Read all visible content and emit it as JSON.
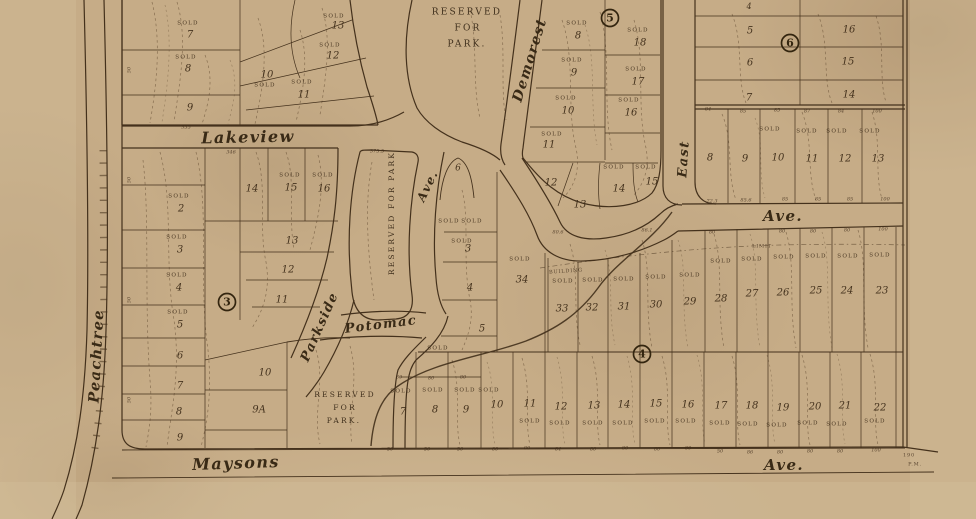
{
  "map": {
    "colors": {
      "paper": "#c6ac87",
      "paper_light": "#d8c4a0",
      "paper_dark": "#b39872",
      "ink": "#44311c"
    },
    "streets": [
      {
        "t": "Lakeview",
        "x": 248,
        "y": 138,
        "s": 16,
        "r": -1
      },
      {
        "t": "Peachtree",
        "x": 97,
        "y": 356,
        "s": 14.5,
        "r": -87
      },
      {
        "t": "Demorest",
        "x": 530,
        "y": 60,
        "s": 14,
        "r": -73
      },
      {
        "t": "East",
        "x": 684,
        "y": 159,
        "s": 13,
        "r": -86
      },
      {
        "t": "Ave.",
        "x": 783,
        "y": 217,
        "s": 15,
        "r": 0
      },
      {
        "t": "Ave.",
        "x": 428,
        "y": 186,
        "s": 12,
        "r": -64
      },
      {
        "t": "Potomac",
        "x": 381,
        "y": 325,
        "s": 13,
        "r": -7
      },
      {
        "t": "Parkside",
        "x": 320,
        "y": 327,
        "s": 13,
        "r": -66
      },
      {
        "t": "Maysons",
        "x": 236,
        "y": 464,
        "s": 16,
        "r": -2
      },
      {
        "t": "Ave.",
        "x": 784,
        "y": 466,
        "s": 15,
        "r": 0
      }
    ],
    "parks": [
      {
        "t": "RESERVED",
        "x": 467,
        "y": 12,
        "s": 9,
        "r": 0
      },
      {
        "t": "FOR",
        "x": 468,
        "y": 28,
        "s": 9,
        "r": 0
      },
      {
        "t": "PARK.",
        "x": 467,
        "y": 44,
        "s": 9,
        "r": 0
      },
      {
        "t": "RESERVED FOR PARK",
        "x": 392,
        "y": 213,
        "s": 7.5,
        "r": -90
      },
      {
        "t": "RESERVED",
        "x": 345,
        "y": 395,
        "s": 7.5,
        "r": 0
      },
      {
        "t": "FOR",
        "x": 345,
        "y": 408,
        "s": 7.5,
        "r": 0
      },
      {
        "t": "PARK.",
        "x": 344,
        "y": 421,
        "s": 7.5,
        "r": 0
      }
    ],
    "badges": [
      {
        "t": "3",
        "x": 227,
        "y": 302
      },
      {
        "t": "4",
        "x": 642,
        "y": 354
      },
      {
        "t": "5",
        "x": 610,
        "y": 18
      },
      {
        "t": "6",
        "x": 790,
        "y": 43
      }
    ],
    "sold_text": "SOLD",
    "solds": [
      {
        "x": 188,
        "y": 23
      },
      {
        "x": 186,
        "y": 57
      },
      {
        "x": 265,
        "y": 85
      },
      {
        "x": 302,
        "y": 82
      },
      {
        "x": 330,
        "y": 45
      },
      {
        "x": 334,
        "y": 16
      },
      {
        "x": 179,
        "y": 196
      },
      {
        "x": 177,
        "y": 237
      },
      {
        "x": 177,
        "y": 275
      },
      {
        "x": 178,
        "y": 312
      },
      {
        "x": 290,
        "y": 175
      },
      {
        "x": 323,
        "y": 175
      },
      {
        "x": 577,
        "y": 23
      },
      {
        "x": 572,
        "y": 60
      },
      {
        "x": 566,
        "y": 98
      },
      {
        "x": 638,
        "y": 30
      },
      {
        "x": 636,
        "y": 69
      },
      {
        "x": 629,
        "y": 100
      },
      {
        "x": 552,
        "y": 134
      },
      {
        "x": 614,
        "y": 167
      },
      {
        "x": 646,
        "y": 167
      },
      {
        "x": 770,
        "y": 129
      },
      {
        "x": 807,
        "y": 131
      },
      {
        "x": 837,
        "y": 131
      },
      {
        "x": 870,
        "y": 131
      },
      {
        "x": 563,
        "y": 281
      },
      {
        "x": 593,
        "y": 280
      },
      {
        "x": 624,
        "y": 279
      },
      {
        "x": 656,
        "y": 277
      },
      {
        "x": 690,
        "y": 275
      },
      {
        "x": 721,
        "y": 261
      },
      {
        "x": 752,
        "y": 259
      },
      {
        "x": 784,
        "y": 257
      },
      {
        "x": 816,
        "y": 256
      },
      {
        "x": 848,
        "y": 256
      },
      {
        "x": 880,
        "y": 255
      },
      {
        "x": 520,
        "y": 259
      },
      {
        "x": 449,
        "y": 221
      },
      {
        "x": 472,
        "y": 221
      },
      {
        "x": 462,
        "y": 241
      },
      {
        "x": 438,
        "y": 348
      },
      {
        "x": 401,
        "y": 391
      },
      {
        "x": 433,
        "y": 390
      },
      {
        "x": 465,
        "y": 390
      },
      {
        "x": 489,
        "y": 390
      },
      {
        "x": 530,
        "y": 421
      },
      {
        "x": 560,
        "y": 423
      },
      {
        "x": 593,
        "y": 423
      },
      {
        "x": 623,
        "y": 423
      },
      {
        "x": 655,
        "y": 421
      },
      {
        "x": 686,
        "y": 421
      },
      {
        "x": 720,
        "y": 423
      },
      {
        "x": 748,
        "y": 424
      },
      {
        "x": 777,
        "y": 425
      },
      {
        "x": 808,
        "y": 423
      },
      {
        "x": 837,
        "y": 424
      },
      {
        "x": 875,
        "y": 421
      }
    ],
    "lots": [
      {
        "t": "7",
        "x": 190,
        "y": 35
      },
      {
        "t": "8",
        "x": 188,
        "y": 69
      },
      {
        "t": "9",
        "x": 190,
        "y": 108
      },
      {
        "t": "10",
        "x": 267,
        "y": 75
      },
      {
        "t": "11",
        "x": 304,
        "y": 95
      },
      {
        "t": "12",
        "x": 333,
        "y": 56
      },
      {
        "t": "13",
        "x": 338,
        "y": 26
      },
      {
        "t": "2",
        "x": 181,
        "y": 209
      },
      {
        "t": "3",
        "x": 180,
        "y": 250
      },
      {
        "t": "4",
        "x": 179,
        "y": 288
      },
      {
        "t": "5",
        "x": 180,
        "y": 325
      },
      {
        "t": "6",
        "x": 180,
        "y": 356
      },
      {
        "t": "7",
        "x": 180,
        "y": 386
      },
      {
        "t": "8",
        "x": 179,
        "y": 412
      },
      {
        "t": "9",
        "x": 180,
        "y": 438
      },
      {
        "t": "14",
        "x": 252,
        "y": 189
      },
      {
        "t": "15",
        "x": 291,
        "y": 188
      },
      {
        "t": "16",
        "x": 324,
        "y": 189
      },
      {
        "t": "13",
        "x": 292,
        "y": 241
      },
      {
        "t": "12",
        "x": 288,
        "y": 270
      },
      {
        "t": "11",
        "x": 282,
        "y": 300
      },
      {
        "t": "10",
        "x": 265,
        "y": 373
      },
      {
        "t": "9A",
        "x": 259,
        "y": 410
      },
      {
        "t": "8",
        "x": 578,
        "y": 36
      },
      {
        "t": "9",
        "x": 574,
        "y": 73
      },
      {
        "t": "10",
        "x": 568,
        "y": 111
      },
      {
        "t": "11",
        "x": 549,
        "y": 145
      },
      {
        "t": "12",
        "x": 551,
        "y": 183
      },
      {
        "t": "13",
        "x": 580,
        "y": 205
      },
      {
        "t": "14",
        "x": 619,
        "y": 189
      },
      {
        "t": "15",
        "x": 652,
        "y": 182
      },
      {
        "t": "16",
        "x": 631,
        "y": 113
      },
      {
        "t": "17",
        "x": 638,
        "y": 82
      },
      {
        "t": "18",
        "x": 640,
        "y": 43
      },
      {
        "t": "4",
        "x": 749,
        "y": 7,
        "s": 8
      },
      {
        "t": "5",
        "x": 750,
        "y": 31
      },
      {
        "t": "6",
        "x": 750,
        "y": 63
      },
      {
        "t": "7",
        "x": 749,
        "y": 98
      },
      {
        "t": "16",
        "x": 849,
        "y": 30
      },
      {
        "t": "15",
        "x": 848,
        "y": 62
      },
      {
        "t": "14",
        "x": 849,
        "y": 95
      },
      {
        "t": "8",
        "x": 710,
        "y": 158
      },
      {
        "t": "9",
        "x": 745,
        "y": 159
      },
      {
        "t": "10",
        "x": 778,
        "y": 158
      },
      {
        "t": "11",
        "x": 812,
        "y": 159
      },
      {
        "t": "12",
        "x": 845,
        "y": 159
      },
      {
        "t": "13",
        "x": 878,
        "y": 159
      },
      {
        "t": "6",
        "x": 458,
        "y": 168,
        "s": 9
      },
      {
        "t": "3",
        "x": 468,
        "y": 249
      },
      {
        "t": "4",
        "x": 470,
        "y": 288
      },
      {
        "t": "5",
        "x": 482,
        "y": 329
      },
      {
        "t": "34",
        "x": 522,
        "y": 280
      },
      {
        "t": "33",
        "x": 562,
        "y": 309
      },
      {
        "t": "32",
        "x": 592,
        "y": 308
      },
      {
        "t": "31",
        "x": 624,
        "y": 307
      },
      {
        "t": "30",
        "x": 656,
        "y": 305
      },
      {
        "t": "29",
        "x": 690,
        "y": 302
      },
      {
        "t": "28",
        "x": 721,
        "y": 299
      },
      {
        "t": "27",
        "x": 752,
        "y": 294
      },
      {
        "t": "26",
        "x": 783,
        "y": 293
      },
      {
        "t": "25",
        "x": 816,
        "y": 291
      },
      {
        "t": "24",
        "x": 847,
        "y": 291
      },
      {
        "t": "23",
        "x": 882,
        "y": 291
      },
      {
        "t": "7",
        "x": 403,
        "y": 412
      },
      {
        "t": "8",
        "x": 435,
        "y": 410
      },
      {
        "t": "9",
        "x": 466,
        "y": 410
      },
      {
        "t": "10",
        "x": 497,
        "y": 405
      },
      {
        "t": "11",
        "x": 530,
        "y": 404
      },
      {
        "t": "12",
        "x": 561,
        "y": 407
      },
      {
        "t": "13",
        "x": 594,
        "y": 406
      },
      {
        "t": "14",
        "x": 624,
        "y": 405
      },
      {
        "t": "15",
        "x": 656,
        "y": 404
      },
      {
        "t": "16",
        "x": 688,
        "y": 405
      },
      {
        "t": "17",
        "x": 721,
        "y": 406
      },
      {
        "t": "18",
        "x": 752,
        "y": 406
      },
      {
        "t": "19",
        "x": 783,
        "y": 408
      },
      {
        "t": "20",
        "x": 815,
        "y": 407
      },
      {
        "t": "21",
        "x": 845,
        "y": 406
      },
      {
        "t": "22",
        "x": 880,
        "y": 408
      }
    ],
    "dims": [
      {
        "t": "355",
        "x": 186,
        "y": 127
      },
      {
        "t": "346",
        "x": 231,
        "y": 152
      },
      {
        "t": "375.5",
        "x": 377,
        "y": 151
      },
      {
        "t": "50",
        "x": 129,
        "y": 70,
        "r": -90
      },
      {
        "t": "50",
        "x": 129,
        "y": 180,
        "r": -90
      },
      {
        "t": "50",
        "x": 129,
        "y": 300,
        "r": -90
      },
      {
        "t": "50",
        "x": 129,
        "y": 400,
        "r": -90
      },
      {
        "t": "84",
        "x": 708,
        "y": 109
      },
      {
        "t": "85",
        "x": 743,
        "y": 111
      },
      {
        "t": "85",
        "x": 777,
        "y": 110
      },
      {
        "t": "87",
        "x": 807,
        "y": 111
      },
      {
        "t": "84",
        "x": 841,
        "y": 111
      },
      {
        "t": "100",
        "x": 877,
        "y": 111
      },
      {
        "t": "72.3",
        "x": 712,
        "y": 201
      },
      {
        "t": "85.6",
        "x": 746,
        "y": 200
      },
      {
        "t": "85",
        "x": 785,
        "y": 199
      },
      {
        "t": "85",
        "x": 818,
        "y": 199
      },
      {
        "t": "85",
        "x": 850,
        "y": 199
      },
      {
        "t": "100",
        "x": 885,
        "y": 199
      },
      {
        "t": "80.6",
        "x": 558,
        "y": 232
      },
      {
        "t": "86.1",
        "x": 647,
        "y": 230
      },
      {
        "t": "80",
        "x": 712,
        "y": 232
      },
      {
        "t": "80",
        "x": 782,
        "y": 231
      },
      {
        "t": "80",
        "x": 813,
        "y": 231
      },
      {
        "t": "80",
        "x": 847,
        "y": 230
      },
      {
        "t": "100",
        "x": 883,
        "y": 229
      },
      {
        "t": "80",
        "x": 399,
        "y": 377
      },
      {
        "t": "80",
        "x": 431,
        "y": 378
      },
      {
        "t": "80",
        "x": 463,
        "y": 377
      },
      {
        "t": "50",
        "x": 390,
        "y": 449
      },
      {
        "t": "50",
        "x": 427,
        "y": 449
      },
      {
        "t": "50",
        "x": 460,
        "y": 449
      },
      {
        "t": "80",
        "x": 495,
        "y": 449
      },
      {
        "t": "80",
        "x": 527,
        "y": 448
      },
      {
        "t": "84",
        "x": 558,
        "y": 449
      },
      {
        "t": "80",
        "x": 593,
        "y": 449
      },
      {
        "t": "80",
        "x": 625,
        "y": 448
      },
      {
        "t": "80",
        "x": 657,
        "y": 449
      },
      {
        "t": "80",
        "x": 688,
        "y": 448
      },
      {
        "t": "50",
        "x": 720,
        "y": 451
      },
      {
        "t": "86",
        "x": 750,
        "y": 452
      },
      {
        "t": "80",
        "x": 780,
        "y": 452
      },
      {
        "t": "80",
        "x": 810,
        "y": 451
      },
      {
        "t": "80",
        "x": 840,
        "y": 451
      },
      {
        "t": "100",
        "x": 876,
        "y": 450
      }
    ],
    "notes": [
      {
        "t": "BUILDING",
        "x": 566,
        "y": 271,
        "r": -4
      },
      {
        "t": "LIMIT",
        "x": 762,
        "y": 246,
        "r": 0
      },
      {
        "t": "190",
        "x": 909,
        "y": 455,
        "r": 0
      },
      {
        "t": "P.M.",
        "x": 915,
        "y": 464,
        "r": 0
      }
    ]
  }
}
